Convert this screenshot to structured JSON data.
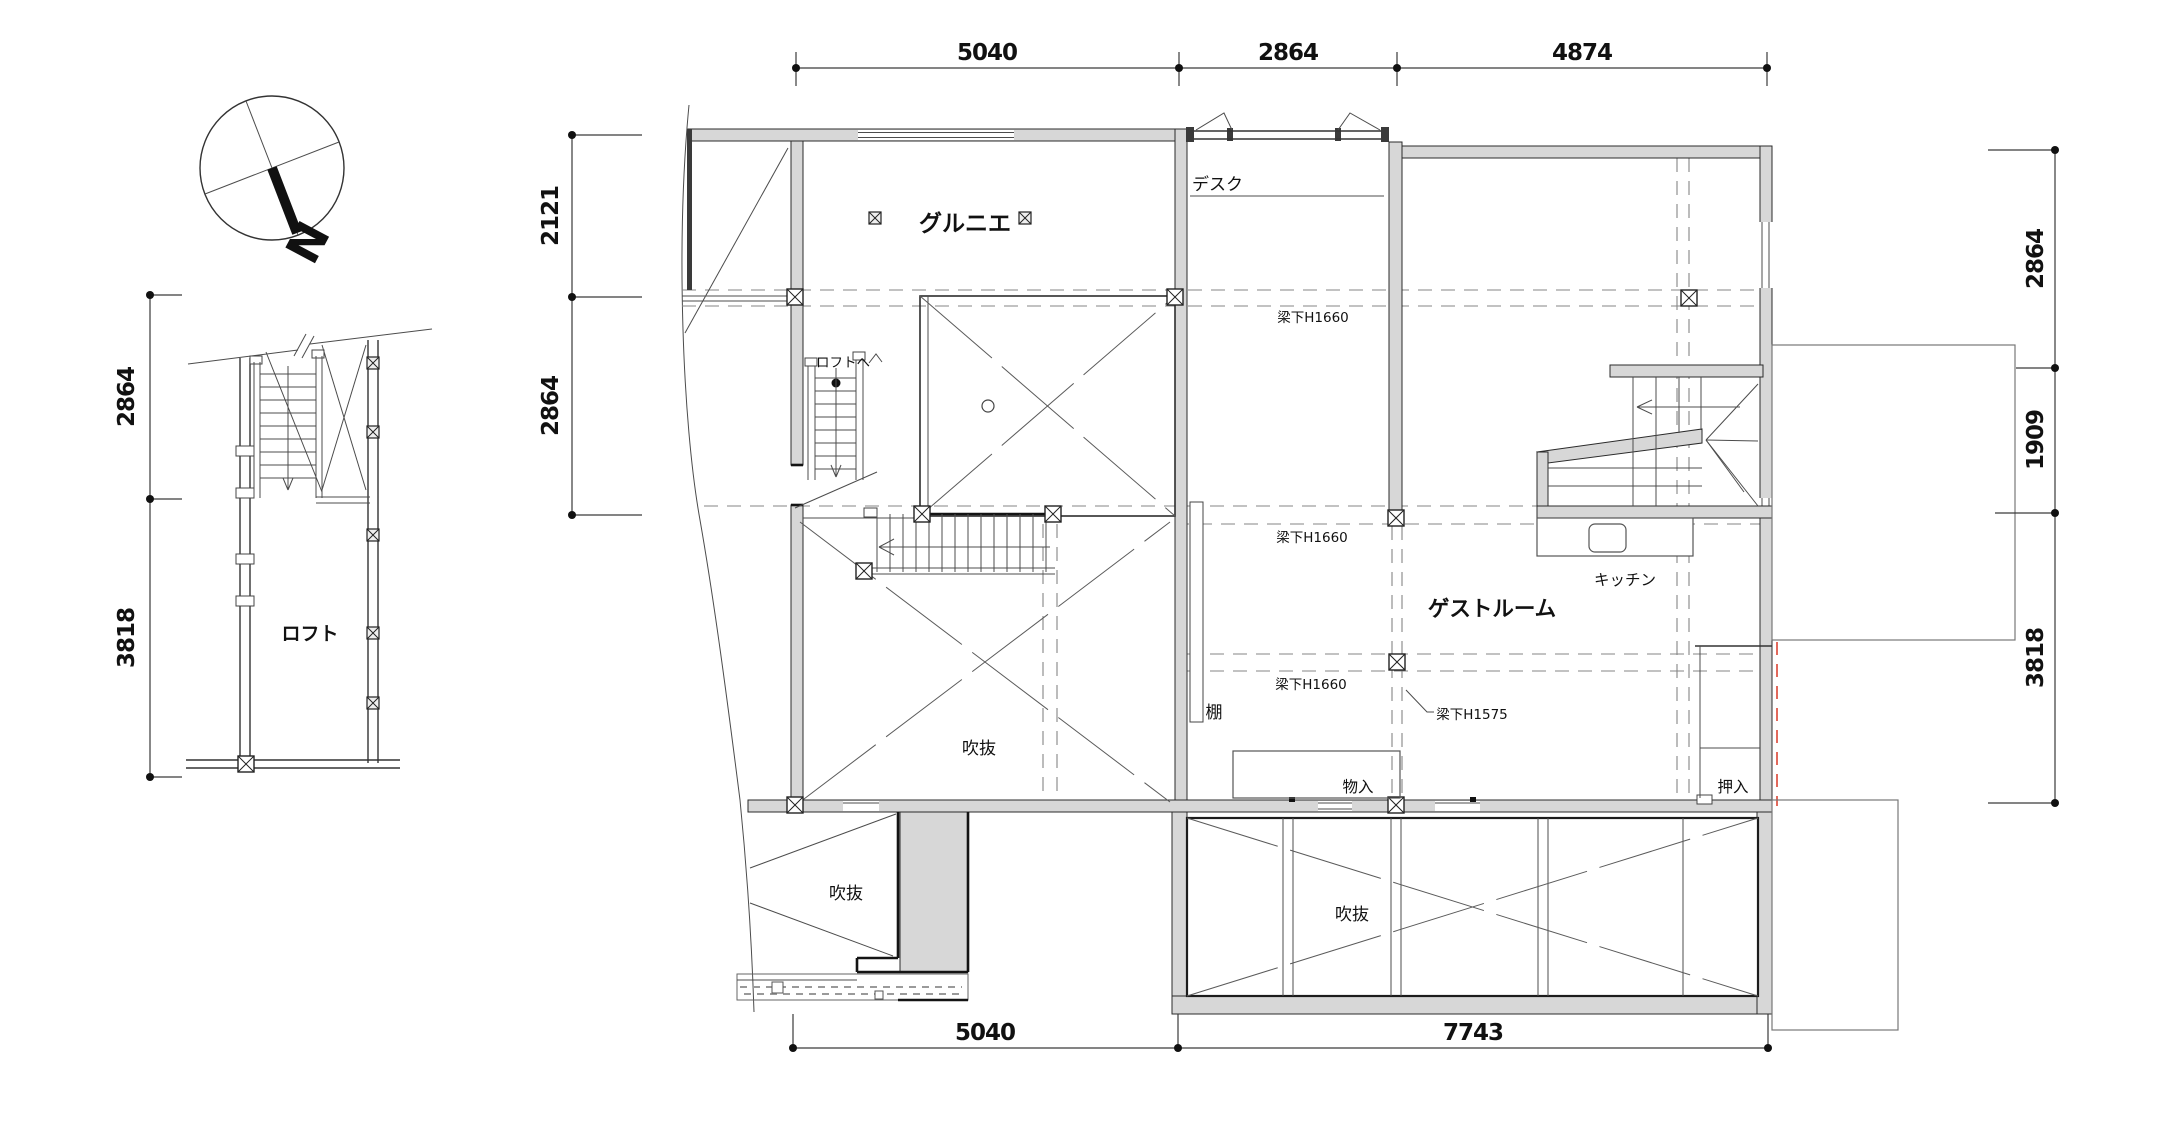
{
  "drawing": {
    "type": "floor-plan",
    "colors": {
      "wall_fill": "#d7d7d7",
      "line": "#3a3a3a",
      "fire_boundary_dash": "#e2695c"
    }
  },
  "compass": {
    "north_label": "N"
  },
  "side_plan": {
    "room_label": "ロフト",
    "dim_upper": "2864",
    "dim_lower": "3818"
  },
  "main_plan": {
    "labels": {
      "grenier": "グルニエ",
      "desk": "デスク",
      "to_loft": "ロフトへ",
      "guest_room": "ゲストルーム",
      "kitchen": "キッチン",
      "shelf": "棚",
      "void_middle": "吹抜",
      "void_bottom_left": "吹抜",
      "void_bottom_center": "吹抜",
      "storage": "物入",
      "closet": "押入"
    },
    "beam_notes": {
      "b1": "梁下H1660",
      "b2": "梁下H1660",
      "b3": "梁下H1660",
      "b4": "梁下H1575"
    },
    "dims": {
      "top_1": "5040",
      "top_2": "2864",
      "top_3": "4874",
      "left_1": "2121",
      "left_2": "2864",
      "right_1": "2864",
      "right_2": "1909",
      "right_3": "3818",
      "bottom_1": "5040",
      "bottom_2": "7743"
    }
  }
}
